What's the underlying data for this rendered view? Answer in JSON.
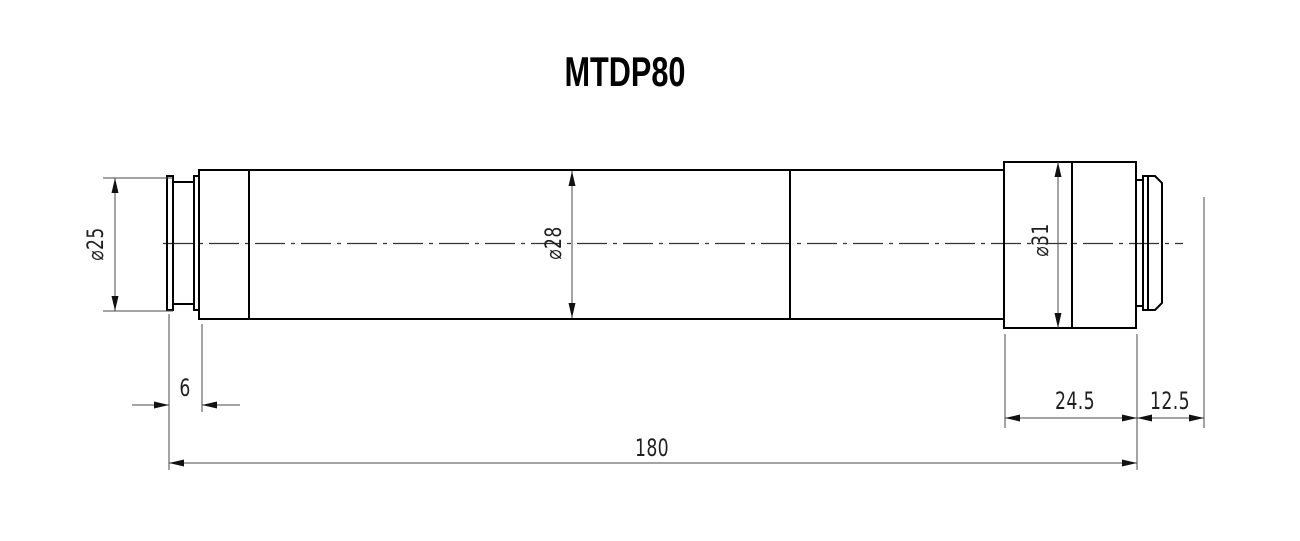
{
  "title": "MTDP80",
  "dimensions": {
    "front_diameter": "⌀25",
    "body_diameter": "⌀28",
    "rear_block_diameter": "⌀31",
    "front_flange_length": "6",
    "rear_block_length": "24.5",
    "rear_tip_length": "12.5",
    "total_length": "180"
  },
  "colors": {
    "background": "#ffffff",
    "outline": "#000000",
    "dimension_lines": "#4a4a4a",
    "centerline": "#333333",
    "text": "#1f1f1f"
  }
}
